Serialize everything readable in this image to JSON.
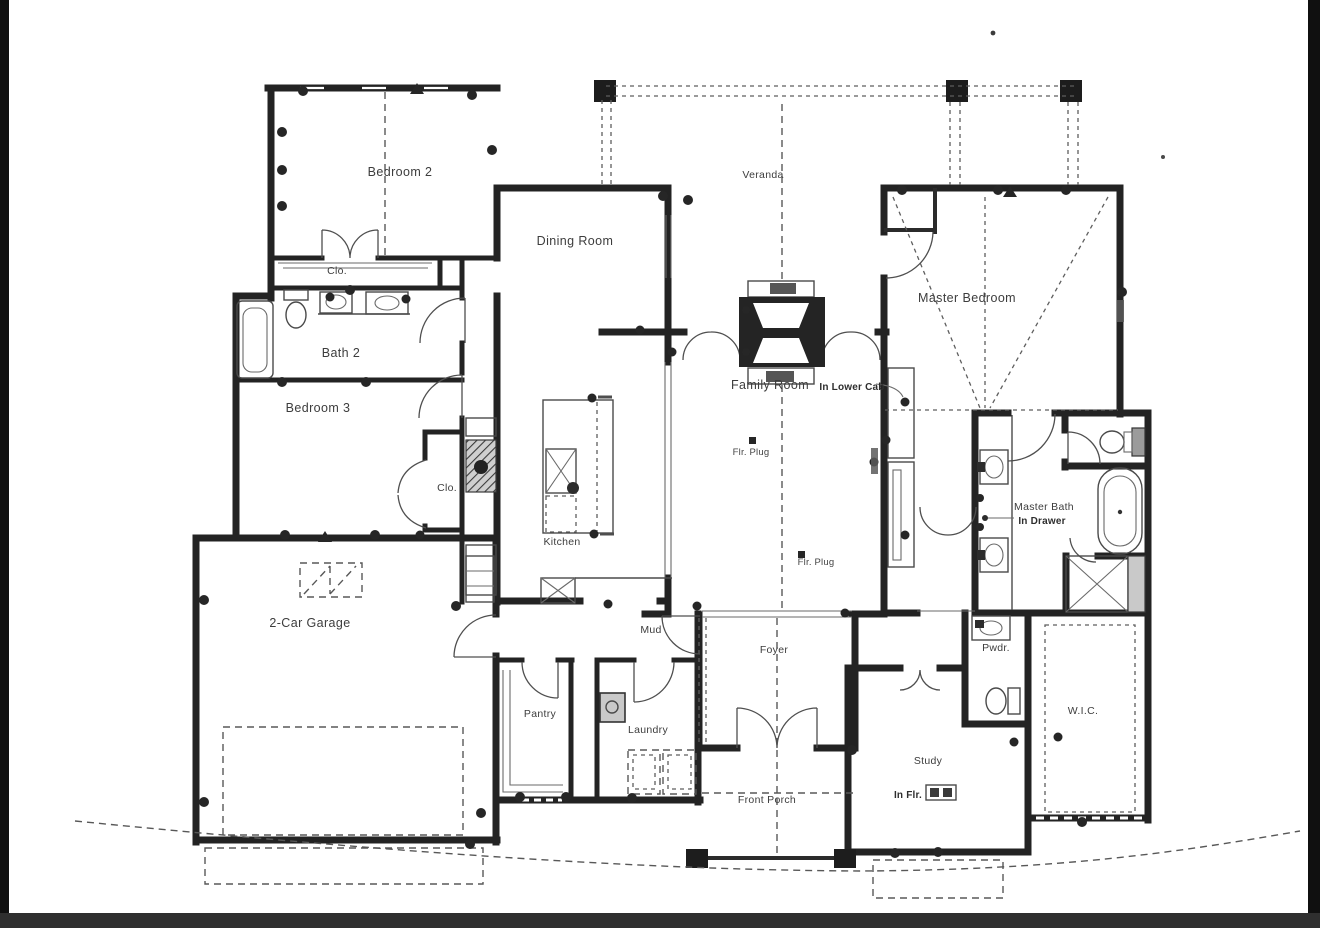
{
  "document": {
    "kind": "scanned residential floor plan (electrical/outlet plan)",
    "paper_color": "#ffffff",
    "line_color": "#232323",
    "frame_color": "#111111",
    "bottom_bar_color": "#2f2f2f"
  },
  "rooms": [
    {
      "id": "bedroom-2",
      "label": "Bedroom 2"
    },
    {
      "id": "closet-bedroom2",
      "label": "Clo."
    },
    {
      "id": "bath-2",
      "label": "Bath 2"
    },
    {
      "id": "bedroom-3",
      "label": "Bedroom 3"
    },
    {
      "id": "closet-hall",
      "label": "Clo."
    },
    {
      "id": "dining-room",
      "label": "Dining Room"
    },
    {
      "id": "veranda",
      "label": "Veranda"
    },
    {
      "id": "master-bedroom",
      "label": "Master Bedroom"
    },
    {
      "id": "family-room",
      "label": "Family Room"
    },
    {
      "id": "kitchen",
      "label": "Kitchen"
    },
    {
      "id": "master-bath",
      "label": "Master Bath"
    },
    {
      "id": "garage",
      "label": "2-Car Garage"
    },
    {
      "id": "mud",
      "label": "Mud"
    },
    {
      "id": "foyer",
      "label": "Foyer"
    },
    {
      "id": "pantry",
      "label": "Pantry"
    },
    {
      "id": "laundry",
      "label": "Laundry"
    },
    {
      "id": "powder",
      "label": "Pwdr."
    },
    {
      "id": "wic",
      "label": "W.I.C."
    },
    {
      "id": "study",
      "label": "Study"
    },
    {
      "id": "front-porch",
      "label": "Front Porch"
    }
  ],
  "annotations": [
    {
      "id": "in-lower-cab",
      "label": "In Lower Cab"
    },
    {
      "id": "flr-plug-family",
      "label": "Flr. Plug"
    },
    {
      "id": "flr-plug-2",
      "label": "Flr. Plug"
    },
    {
      "id": "in-drawer",
      "label": "In Drawer"
    },
    {
      "id": "in-flr",
      "label": "In Flr."
    }
  ]
}
